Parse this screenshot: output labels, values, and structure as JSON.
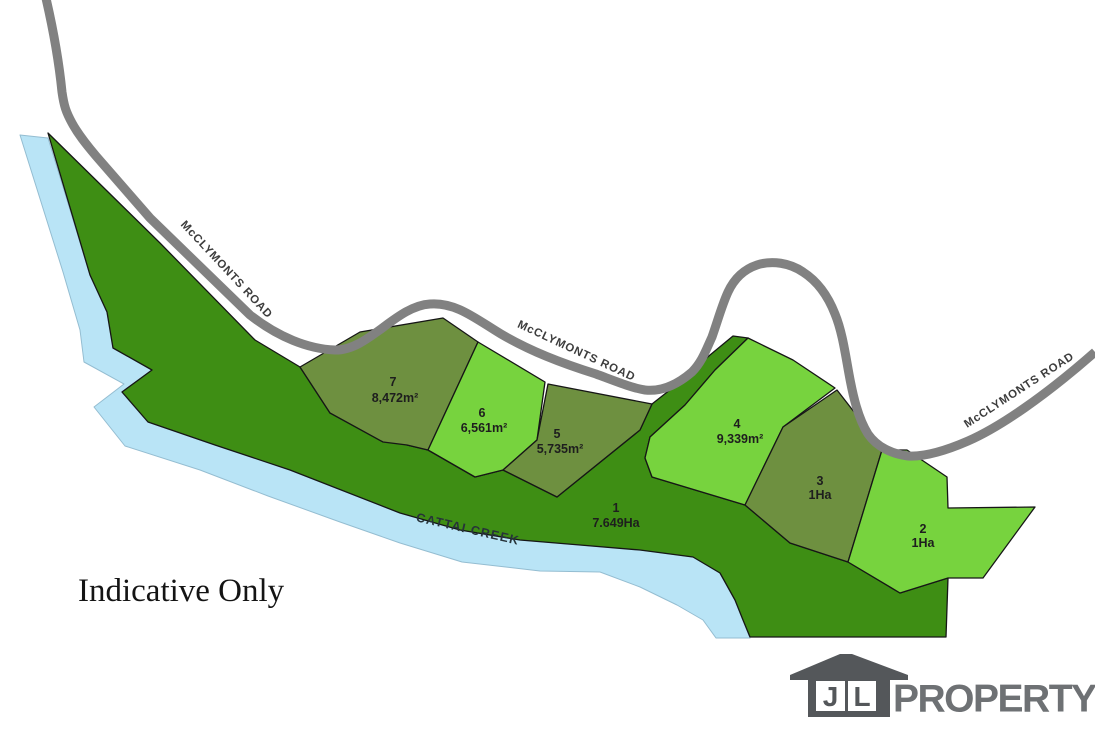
{
  "map": {
    "road_label": "McCLYMONTS ROAD",
    "creek_label": "CATTAI CREEK",
    "note": "Indicative Only",
    "lots": [
      {
        "number": "1",
        "area": "7.649Ha",
        "shade": "dark"
      },
      {
        "number": "2",
        "area": "1Ha",
        "shade": "bright"
      },
      {
        "number": "3",
        "area": "1Ha",
        "shade": "olive"
      },
      {
        "number": "4",
        "area": "9,339m²",
        "shade": "bright"
      },
      {
        "number": "5",
        "area": "5,735m²",
        "shade": "olive"
      },
      {
        "number": "6",
        "area": "6,561m²",
        "shade": "bright"
      },
      {
        "number": "7",
        "area": "8,472m²",
        "shade": "olive"
      }
    ],
    "colors": {
      "lot_dark": "#3e8e14",
      "lot_olive": "#6e9040",
      "lot_bright": "#77d33e",
      "creek": "#b9e4f6",
      "road": "#818181",
      "lot_text": "#1e1e1e",
      "road_text": "#3d3d3d"
    }
  },
  "logo": {
    "letters": [
      "J",
      "L"
    ],
    "name": "PROPERTY",
    "house_color": "#54575a",
    "text_color": "#6e7174"
  }
}
